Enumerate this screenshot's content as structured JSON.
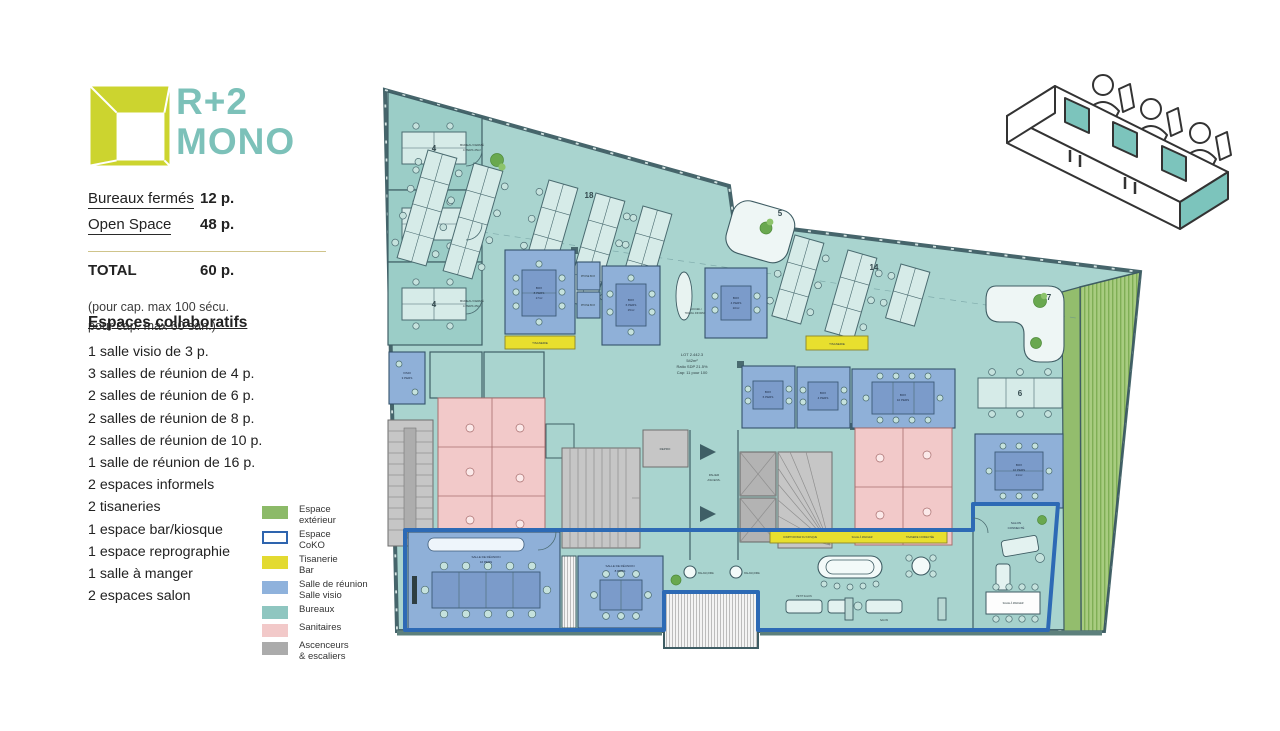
{
  "header": {
    "title_line1": "R+2",
    "title_line2": "MONO"
  },
  "colors": {
    "accent_teal": "#7cc1b9",
    "logo_yellow": "#ccd42f",
    "coko_blue": "#2d6ab5",
    "exterior_green": "#8cba68",
    "tisanerie_yellow": "#e3da31",
    "meeting_blue": "#8fb2dc",
    "bureaux_teal": "#8fc6c0",
    "sanitaires_pink": "#f2c9c9",
    "stairs_gray": "#ababab"
  },
  "stats": {
    "row1_label": "Bureaux fermés",
    "row1_value": "12 p.",
    "row2_label": "Open Space",
    "row2_value": "48 p.",
    "total_label": "TOTAL",
    "total_value": "60 p.",
    "note1": "(pour cap. max 100 sécu.",
    "note2": "pour cap. max 60 san.)"
  },
  "collab": {
    "heading": "Espaces collaboratifs",
    "items": [
      "1 salle visio de 3 p.",
      "3 salles de réunion de 4 p.",
      "2 salles de réunion de 6 p.",
      "2 salles de réunion de 8 p.",
      "2 salles de réunion de 10 p.",
      "1 salle de réunion de 16 p.",
      "2 espaces informels",
      "2 tisaneries",
      "1 espace bar/kiosque",
      "1 espace reprographie",
      "1 salle à manger",
      "2 espaces salon"
    ]
  },
  "legend": {
    "items": [
      {
        "label": "Espace\nextérieur",
        "color": "#8cba68"
      },
      {
        "label": "Espace\nCoKO",
        "color": "#ffffff"
      },
      {
        "label": "Tisanerie\nBar",
        "color": "#e3da31"
      },
      {
        "label": "Salle de réunion\nSalle visio",
        "color": "#8fb2dc"
      },
      {
        "label": "Bureaux",
        "color": "#8fc6c0"
      },
      {
        "label": "Sanitaires",
        "color": "#f2c9c9"
      },
      {
        "label": "Ascenceurs\n& escaliers",
        "color": "#ababab"
      }
    ]
  },
  "plan": {
    "lot": {
      "l1": "LOT 2.442.3",
      "l2": "542m²",
      "l3": "Ratio SDP 21.5%",
      "l4": "Cap: 11 pour 100"
    },
    "desks": {
      "d4": "4",
      "d18": "18",
      "d5": "5",
      "d14": "14",
      "d6": "6",
      "d7": "7"
    },
    "rooms": {
      "office_l1": "BUREAU FERMÉ",
      "office_l2": "4 PERS 25m²",
      "visio3_l1": "VISIO",
      "visio3_l2": "3 PERS",
      "box8_l1": "BOX",
      "box8_l2": "8 PERS",
      "box8_l3": "17m²",
      "phonebox": "PHONE BOX",
      "box6_l1": "BOX",
      "box6_l2": "6 PERS",
      "box6_l3": "15m²",
      "box4_l1": "BOX",
      "box4_l2": "4 PERS",
      "box4_l3": "10m²",
      "box6b_l1": "BOX",
      "box6b_l2": "6 PERS",
      "box4b_l1": "BOX",
      "box4b_l2": "4 PERS",
      "box10a_l1": "BOX",
      "box10a_l2": "10 PERS",
      "box10b_l1": "BOX",
      "box10b_l2": "10 PERS",
      "box10b_l3": "21m²",
      "tisanerie": "TISANERIE",
      "accueil_l1": "ACCUEIL /",
      "accueil_l2": "TRAVAIL INFORMEL",
      "palier_l1": "PALIER",
      "palier_l2": "ASCENS.",
      "repro": "REPRO",
      "salle16_l1": "SALLE DE RÉUNION",
      "salle16_l2": "16 PERS",
      "salle8_l1": "SALLE DE RÉUNION",
      "salle8_l2": "8 PERS",
      "bar1": "COMPTOIR BAR DU KIOSQUE",
      "bar2": "SALLE À MANGER",
      "bar3": "TISANERIE CONNECTÉE",
      "petit_salon": "PETIT SALON",
      "salon": "SALON",
      "salon_connecte_l1": "SALON",
      "salon_connecte_l2": "CONNECTÉ",
      "salle_a_manger": "SALLE À MANGER",
      "balancoire": "BALANÇOIRE"
    }
  }
}
